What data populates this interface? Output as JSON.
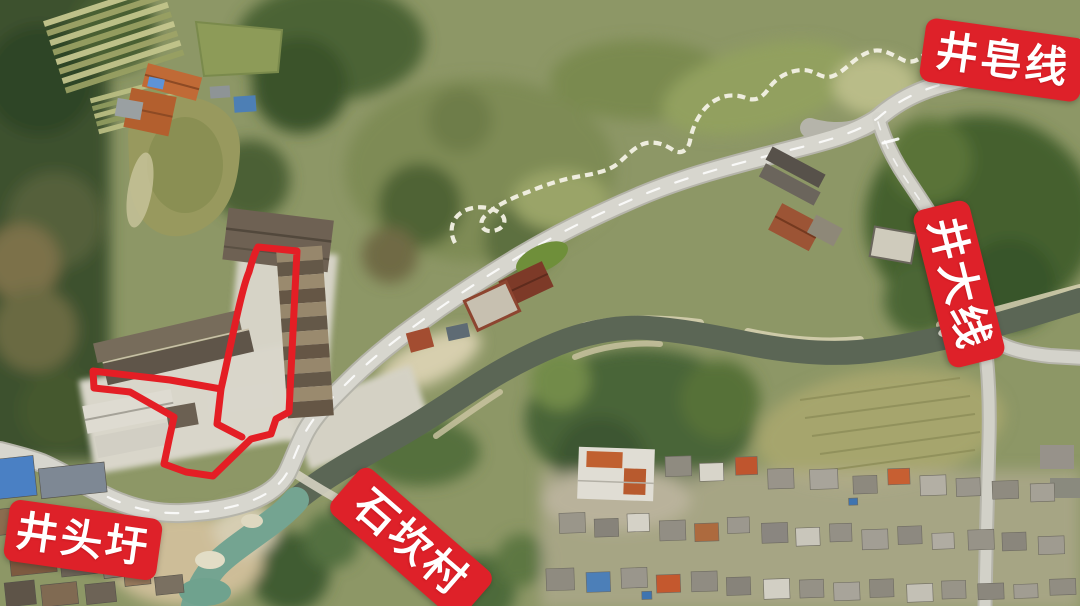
{
  "map": {
    "annotation_color": "#de2129",
    "outline_color": "#e41e25",
    "labels": [
      {
        "id": "jing-zao-line",
        "text": "井皂线"
      },
      {
        "id": "jing-da-line",
        "text": "井大线"
      },
      {
        "id": "shi-kan-village",
        "text": "石坎村"
      },
      {
        "id": "jing-tou-xu",
        "text": "井头圩"
      }
    ]
  }
}
